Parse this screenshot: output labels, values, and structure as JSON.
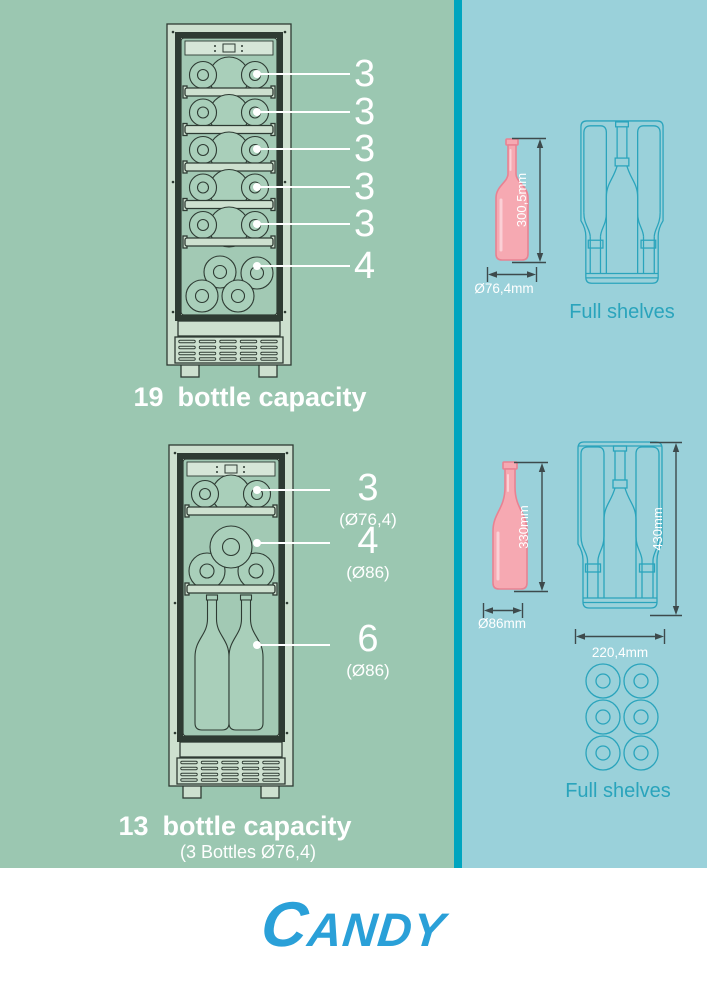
{
  "colors": {
    "left_bg": "#9bc7b1",
    "right_bg": "#9ad1da",
    "divider": "#00a5bf",
    "cooler_body": "#cde0cf",
    "cooler_glass": "#a2c9b4",
    "outline_dark": "#2e3b33",
    "teal_line": "#2aa4bc",
    "bottle_pink": "#f6a9b2",
    "bottle_pink_outline": "#e88292",
    "dimension_line": "#3d4a4c",
    "text_white": "#ffffff",
    "brand_blue": "#2aa0d8"
  },
  "left_panel": {
    "cooler_19": {
      "shelf_labels": [
        "3",
        "3",
        "3",
        "3",
        "3",
        "4"
      ],
      "caption": {
        "number": "19",
        "text": "bottle capacity"
      }
    },
    "cooler_13": {
      "shelf_labels": [
        {
          "number": "3",
          "detail": "(Ø76,4)"
        },
        {
          "number": "4",
          "detail": "(Ø86)"
        },
        {
          "number": "6",
          "detail": "(Ø86)"
        }
      ],
      "caption": {
        "number": "13",
        "text": "bottle capacity",
        "subtext": "(3 Bottles Ø76,4)"
      }
    }
  },
  "right_panel": {
    "top_group": {
      "bottle": {
        "height_label": "300,5mm",
        "diameter_label": "Ø76,4mm"
      },
      "shelves_label": "Full shelves"
    },
    "bottom_group": {
      "bottle": {
        "height_label": "330mm",
        "diameter_label": "Ø86mm"
      },
      "shelf": {
        "height_label": "430mm",
        "width_label": "220,4mm"
      },
      "shelves_label": "Full shelves"
    }
  },
  "footer": {
    "brand": "CANDY"
  }
}
